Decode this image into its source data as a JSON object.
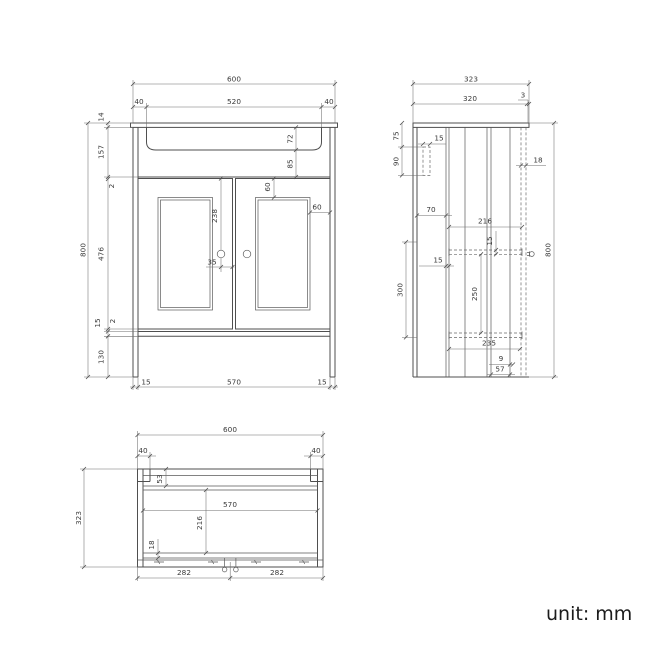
{
  "meta": {
    "unit_label": "unit: mm"
  },
  "front_view": {
    "top": {
      "overall_width": "600",
      "left_lip": "40",
      "basin_width": "520",
      "right_lip": "40"
    },
    "left": {
      "overall_height": "800",
      "top_thickness": "14",
      "basin_zone": "157",
      "gap_top": "2",
      "door_height": "476",
      "bottom_rail": "15",
      "gap_bottom": "2",
      "plinth_height": "130"
    },
    "inner": {
      "basin_depth": "72",
      "basin_clearance": "85",
      "door_inset_top": "60",
      "door_inset_side": "60",
      "handle_drop": "238",
      "handle_offset": "35"
    },
    "bottom": {
      "left_panel": "15",
      "inner_width": "570",
      "right_panel": "15"
    }
  },
  "side_view": {
    "top": {
      "overall_depth": "323",
      "body_depth": "320",
      "front_lip": "3"
    },
    "right": {
      "overall_height": "800"
    },
    "labels": {
      "bracket_offset": "75",
      "bracket_height": "90",
      "bracket_depth": "15",
      "door_thickness": "18",
      "back_clearance": "70",
      "shelf_depth": "216",
      "shelf_thickness": "15",
      "back_gap": "15",
      "shelf_zone": "300",
      "shelf_clearance": "250",
      "bottom_depth": "235",
      "toe_lip": "9",
      "leg_depth": "57"
    }
  },
  "bottom_view": {
    "top": {
      "overall_width": "600",
      "left_lip": "40",
      "right_lip": "40"
    },
    "left": {
      "overall_depth": "323"
    },
    "labels": {
      "back_rail": "53",
      "inner_width": "570",
      "inner_depth": "216",
      "front_rail": "18",
      "knob_left": "282",
      "knob_right": "282"
    }
  }
}
